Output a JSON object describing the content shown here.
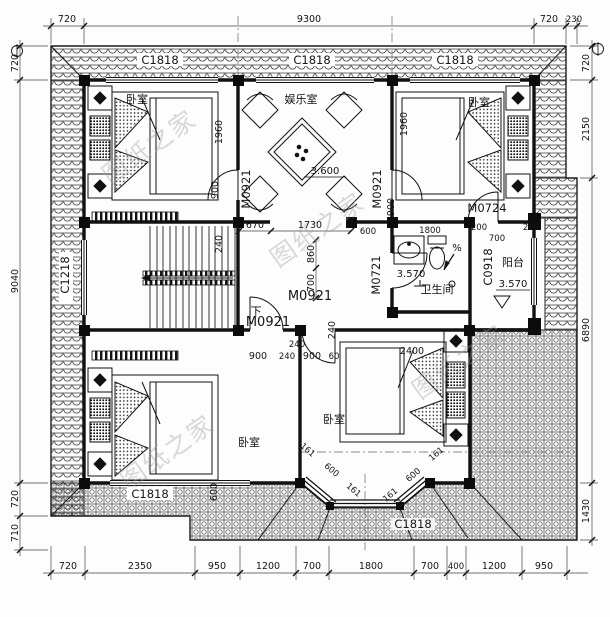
{
  "drawing": {
    "watermark": "图纸之家",
    "rooms": {
      "bedroom": "卧室",
      "entertainment": "娱乐室",
      "bathroom": "卫生间",
      "balcony": "阳台",
      "down": "下"
    },
    "levels": {
      "entertainment": "3.600",
      "bathroom": "3.570",
      "balcony": "3.570"
    },
    "openings": {
      "c1818": "C1818",
      "c1218": "C1218",
      "c0918": "C0918",
      "m0921": "M0921",
      "m0721": "M0721",
      "m0724": "M0724"
    },
    "slope_mark": "%",
    "dims": {
      "top": [
        "720",
        "9300",
        "720",
        "230"
      ],
      "left": [
        "720",
        "9040",
        "720",
        "710"
      ],
      "right": [
        "720",
        "2150",
        "6890",
        "1430"
      ],
      "bottom": [
        "720",
        "2350",
        "950",
        "1200",
        "700",
        "1800",
        "700",
        "400",
        "1200",
        "950"
      ],
      "bed_1960": "1960",
      "bed_900": "900",
      "stair_240": "240",
      "hall_670": "670",
      "hall_1730": "1730",
      "hall_860": "860",
      "hall_700": "700",
      "hall_240": "240",
      "row_900": "900",
      "row_60": "60",
      "row_2400": "2400",
      "bath_600": "600",
      "bath_1800": "1800",
      "tr_200": "200",
      "tr_700": "700",
      "tr_260": "260",
      "bl_600": "600",
      "bay_161": "161",
      "bay_600": "600"
    }
  }
}
